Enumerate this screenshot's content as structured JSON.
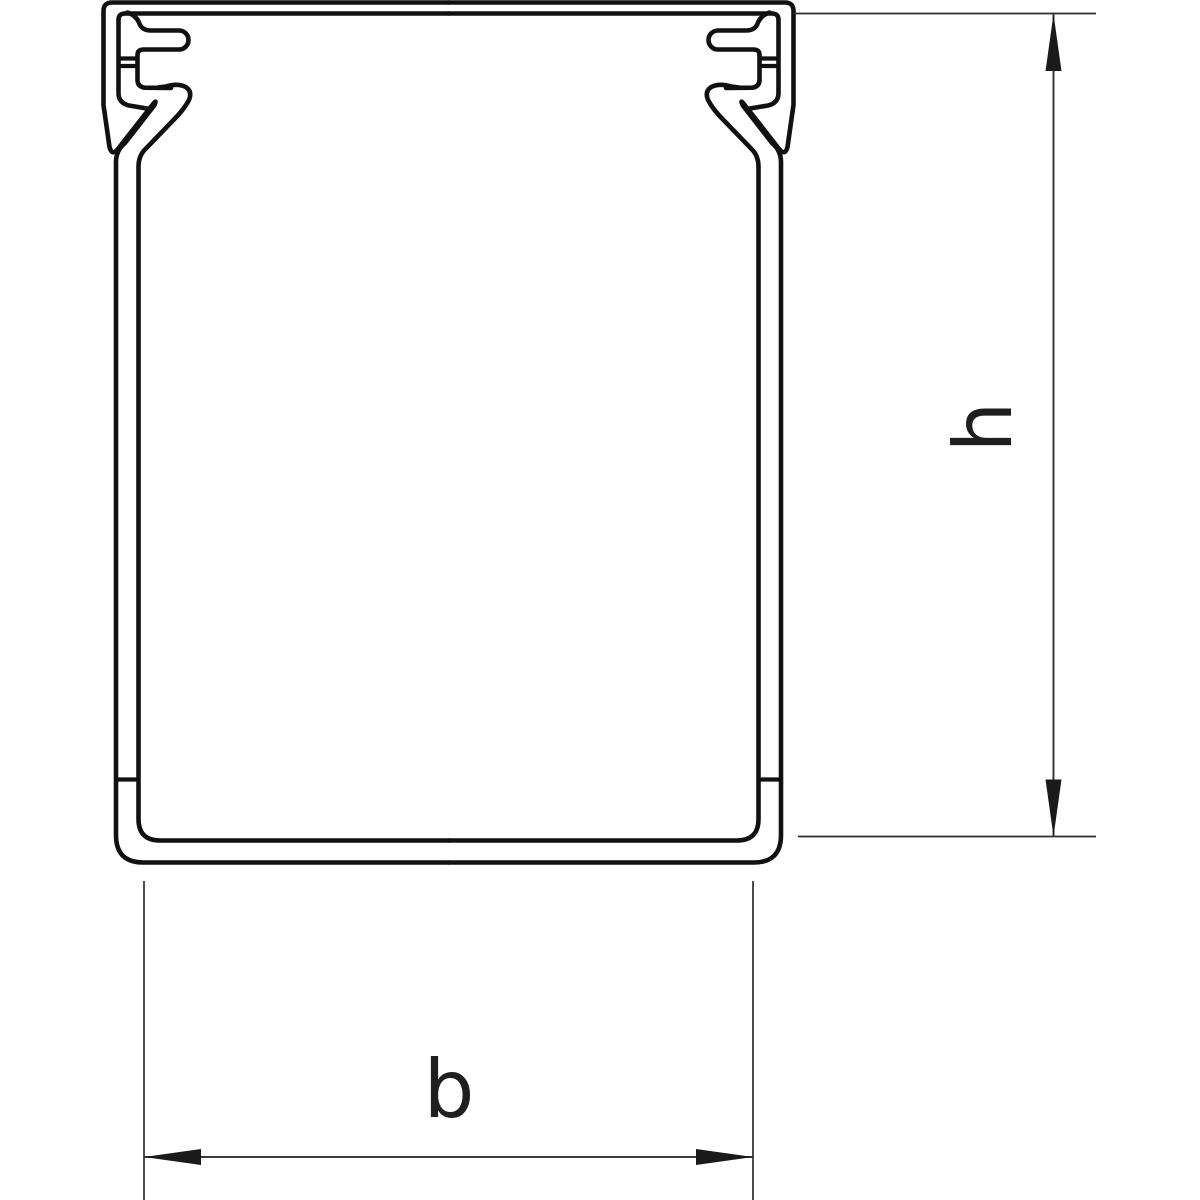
{
  "drawing": {
    "type": "technical-cross-section",
    "subject": "wiring-duct-profile-with-cover-clips",
    "colors": {
      "background": "#ffffff",
      "profile_line": "#111111",
      "dimension_line": "#3a3a3a",
      "label_text": "#1f1f1f"
    },
    "dimensions": {
      "height_label": "h",
      "width_label": "b"
    }
  }
}
